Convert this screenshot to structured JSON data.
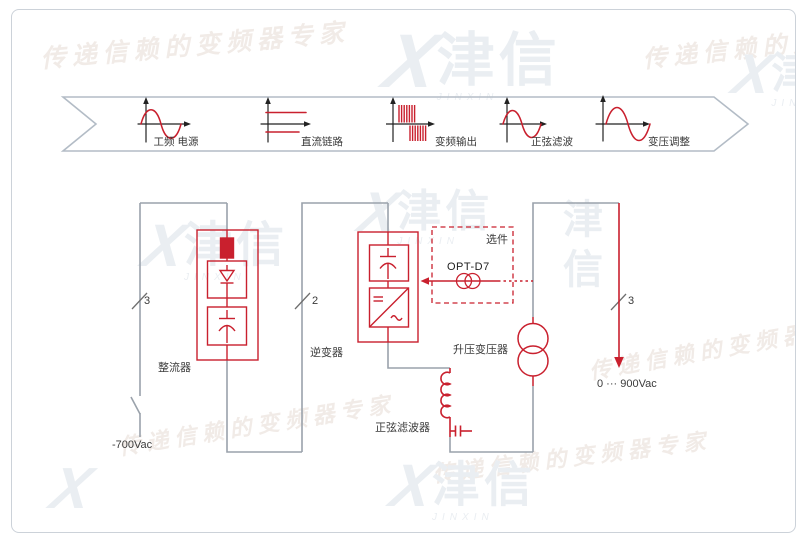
{
  "banner": {
    "stages": [
      {
        "label": "工频 电源",
        "icon": "sine-wave-icon"
      },
      {
        "label": "直流链路",
        "icon": "dc-rails-icon"
      },
      {
        "label": "变频输出",
        "icon": "pwm-pulses-icon"
      },
      {
        "label": "正弦滤波",
        "icon": "sine-wave-icon"
      },
      {
        "label": "变压调整",
        "icon": "sine-wave-icon"
      }
    ]
  },
  "circuit": {
    "labels": {
      "rectifier": "整流器",
      "inverter": "逆变器",
      "sine_filter": "正弦滤波器",
      "transformer": "升压变压器",
      "option_title": "选件",
      "option_part": "OPT-D7",
      "input_voltage": "-700Vac",
      "output_voltage": "0 ··· 900Vac"
    },
    "phase_marks": {
      "input": "3",
      "dc_link": "2",
      "output": "3"
    },
    "colors": {
      "wire": "#9aa2ab",
      "component": "#c9202e",
      "text": "#3b3b3b"
    }
  },
  "watermark": {
    "slogan": "传递信赖的变频器专家",
    "brand": "津信",
    "brand_latin": "JINXIN",
    "mark": "X"
  }
}
